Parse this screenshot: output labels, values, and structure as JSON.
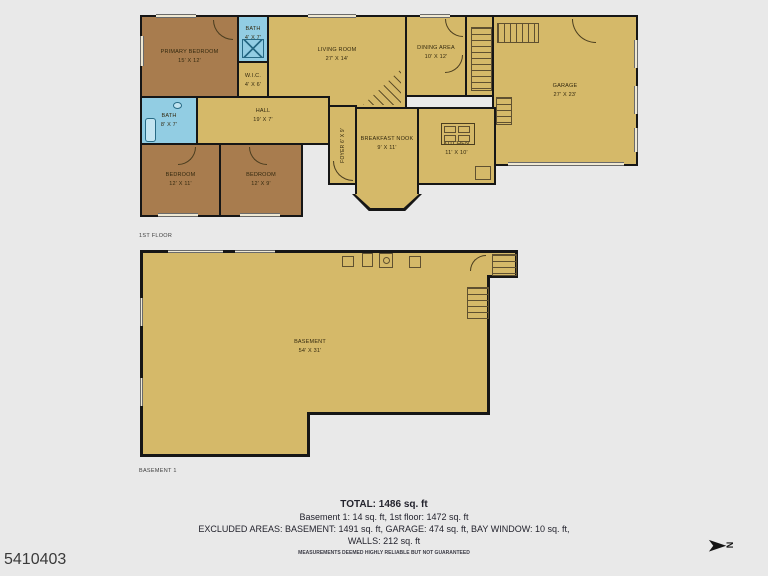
{
  "mls_number": "5410403",
  "north_letter": "N",
  "colors": {
    "floor_tan": "#d5b969",
    "bedroom_brown": "#a87c4e",
    "bath_blue": "#92cde3",
    "wall_black": "#161616",
    "background": "#e9e9e9"
  },
  "floor1": {
    "caption": "1ST FLOOR",
    "rooms": {
      "primary_bedroom": {
        "name": "PRIMARY BEDROOM",
        "dims": "15' X 12'"
      },
      "bath_top": {
        "name": "BATH",
        "dims": "4' X 7'"
      },
      "wic": {
        "name": "W.I.C.",
        "dims": "4' X 6'"
      },
      "living_room": {
        "name": "LIVING ROOM",
        "dims": "27' X 14'"
      },
      "dining_area": {
        "name": "DINING AREA",
        "dims": "10' X 12'"
      },
      "garage": {
        "name": "GARAGE",
        "dims": "27' X 23'"
      },
      "bath_left": {
        "name": "BATH",
        "dims": "8' X 7'"
      },
      "hall": {
        "name": "HALL",
        "dims": "19' X 7'"
      },
      "foyer": {
        "name": "FOYER",
        "dims": "6' X 9'"
      },
      "bedroom_1": {
        "name": "BEDROOM",
        "dims": "12' X 11'"
      },
      "bedroom_2": {
        "name": "BEDROOM",
        "dims": "12' X 9'"
      },
      "breakfast_nook": {
        "name": "BREAKFAST NOOK",
        "dims": "9' X 11'"
      },
      "kitchen": {
        "name": "KITCHEN",
        "dims": "11' X 10'"
      }
    }
  },
  "basement_floor": {
    "caption": "BASEMENT 1",
    "rooms": {
      "basement": {
        "name": "BASEMENT",
        "dims": "54' X 31'"
      }
    }
  },
  "summary": {
    "total": "TOTAL: 1486 sq. ft",
    "line2": "Basement 1: 14 sq. ft, 1st floor: 1472 sq. ft",
    "line3": "EXCLUDED AREAS: BASEMENT: 1491 sq. ft, GARAGE: 474 sq. ft, BAY WINDOW: 10 sq. ft,",
    "line4": "WALLS: 212 sq. ft",
    "disclaimer": "MEASUREMENTS DEEMED HIGHLY RELIABLE BUT NOT GUARANTEED"
  }
}
